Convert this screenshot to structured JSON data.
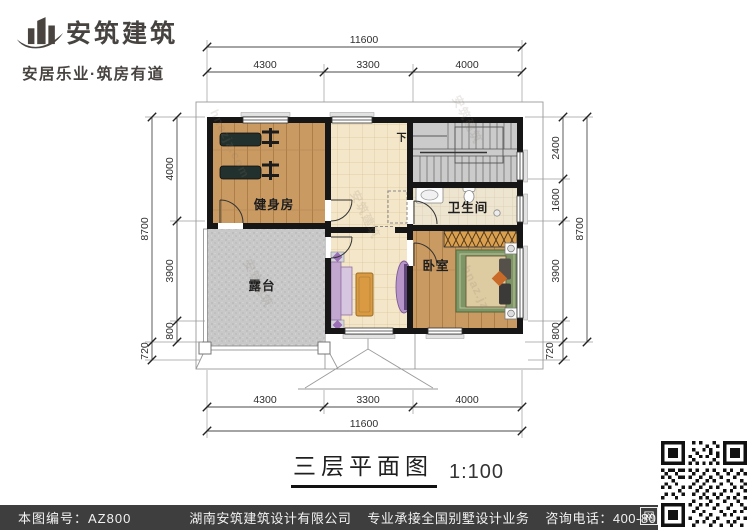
{
  "logo": {
    "company": "安筑建筑",
    "tagline": "安居乐业·筑房有道"
  },
  "plan": {
    "rooms": {
      "gym": "健身房",
      "bath": "卫生间",
      "terrace": "露台",
      "bedroom": "卧室"
    },
    "stair_direction": "下"
  },
  "dims": {
    "top": {
      "total": "11600",
      "segments": [
        "4300",
        "3300",
        "4000"
      ]
    },
    "bottom": {
      "total": "11600",
      "segments": [
        "4300",
        "3300",
        "4000"
      ]
    },
    "left": {
      "total": "8700",
      "segments": [
        "4000",
        "3900",
        "800"
      ],
      "offset": "720"
    },
    "right": {
      "total": "8700",
      "segments": [
        "2400",
        "1600",
        "3900",
        "800"
      ],
      "offset": "720"
    }
  },
  "title": {
    "name": "三层平面图",
    "scale": "1:100"
  },
  "watermarks": {
    "w1": "hnazjz.com",
    "w2": "安筑建筑",
    "w3": "hnaz.jz"
  },
  "footer": {
    "drawing_no": "本图编号：AZ800",
    "company": "湖南安筑建筑设计有限公司",
    "service": "专业承接全国别墅设计业务",
    "phone": "咨询电话：400-8070-511",
    "web": "网"
  },
  "colors": {
    "wall": "#161616",
    "wood": "#c99a62",
    "tile": "#f4e7c9",
    "terrace": "#c8c8c8",
    "footer_bar": "#3e3e3e"
  }
}
